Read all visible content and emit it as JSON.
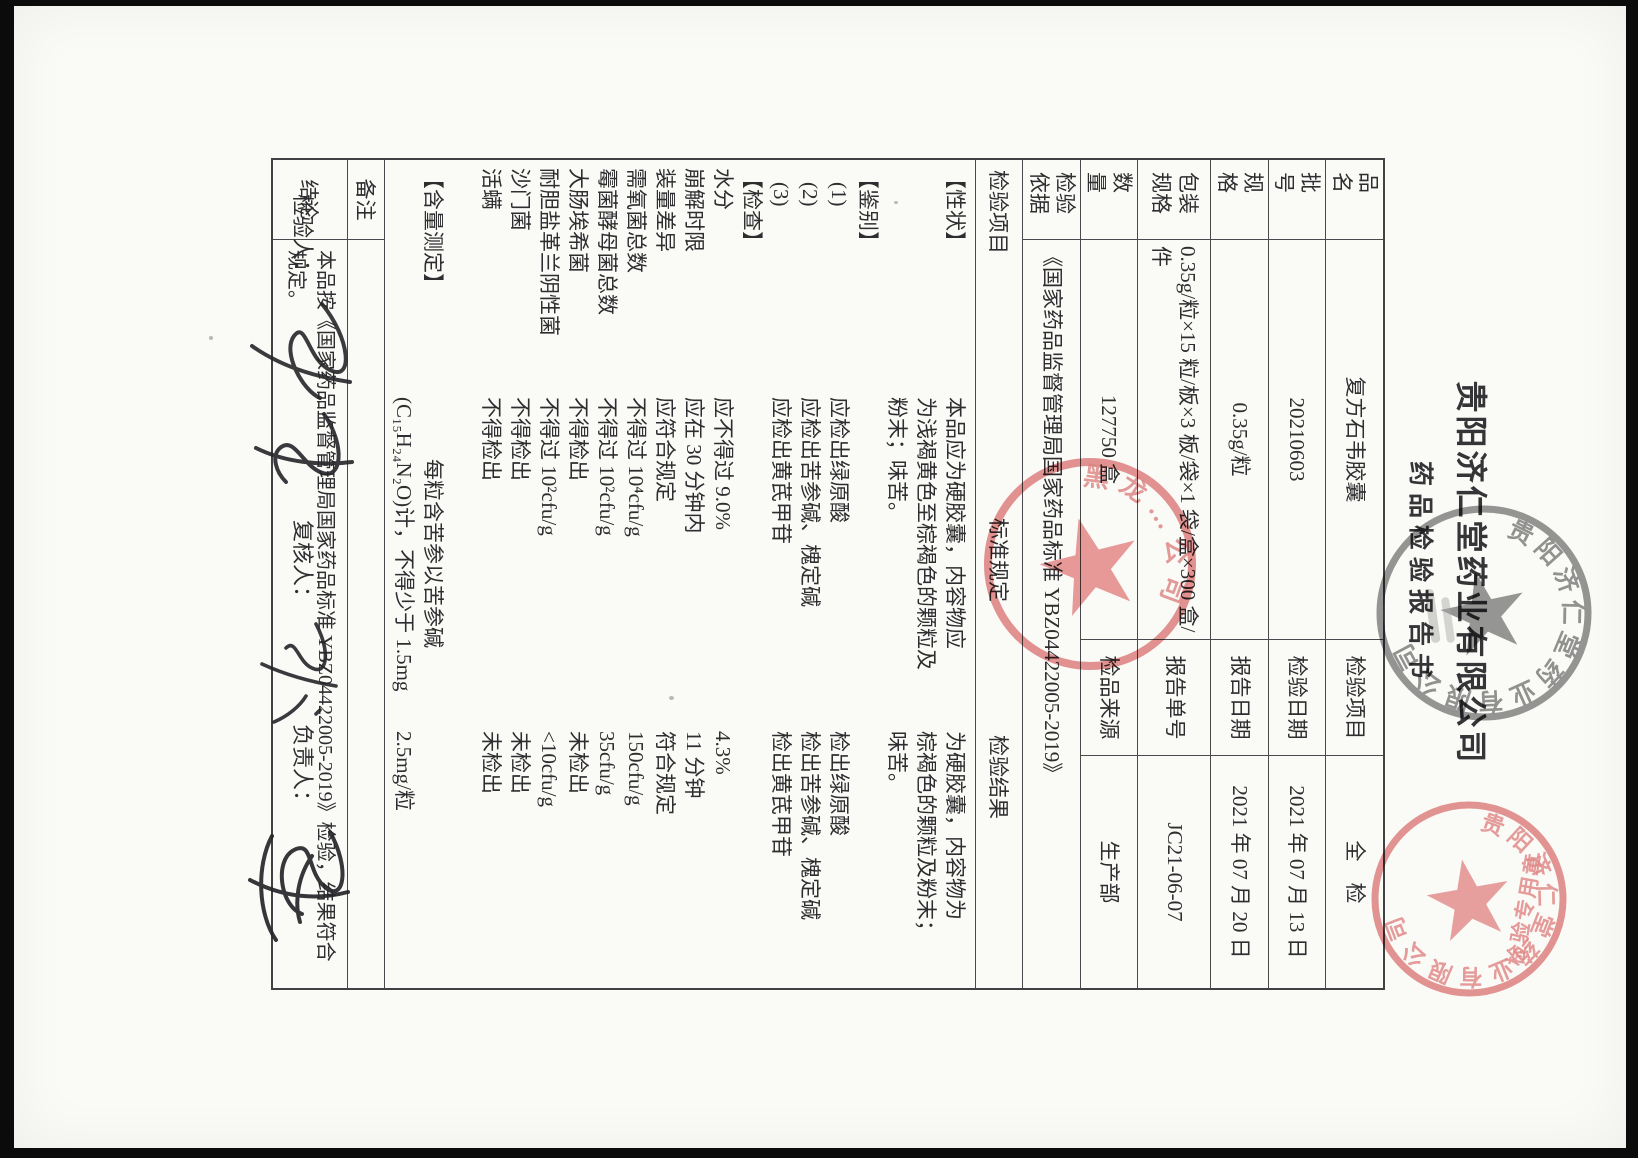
{
  "header": {
    "company_title": "贵阳济仁堂药业有限公司",
    "report_title": "药品检验报告书"
  },
  "info_table": {
    "rows": [
      {
        "label": "品　名",
        "value": "复方石韦胶囊",
        "label2": "检验项目",
        "value2": "全　检"
      },
      {
        "label": "批　号",
        "value": "20210603",
        "label2": "检验日期",
        "value2": "2021 年 07 月 13 日"
      },
      {
        "label": "规　格",
        "value": "0.35g/粒",
        "label2": "报告日期",
        "value2": "2021 年 07 月 20 日"
      },
      {
        "label": "包装规格",
        "value": "0.35g/粒×15 粒/板×3 板/袋×1 袋/盒×300 盒/件",
        "label2": "报告单号",
        "value2": "JC21-06-07"
      },
      {
        "label": "数　量",
        "value": "127750 盒",
        "label2": "检品来源",
        "value2": "生产部"
      },
      {
        "label": "检验依据",
        "value": "《国家药品监督管理局国家药品标准 YBZ04422005-2019》"
      }
    ]
  },
  "result_table": {
    "headers": [
      "检验项目",
      "标准规定",
      "检验结果"
    ],
    "lines": [
      {
        "item": "【性状】",
        "std": "本品应为硬胶囊，内容物应",
        "result": "为硬胶囊，内容物为"
      },
      {
        "item": "",
        "std": "为浅褐黄色至棕褐色的颗粒及",
        "result": "棕褐色的颗粒及粉末；"
      },
      {
        "item": "",
        "std": "粉末；味苦。",
        "result": "味苦。"
      },
      {
        "item": "【鉴别】",
        "std": "",
        "result": ""
      },
      {
        "item": "(1)",
        "std": "应检出绿原酸",
        "result": "检出绿原酸"
      },
      {
        "item": "(2)",
        "std": "应检出苦参碱、槐定碱",
        "result": "检出苦参碱、槐定碱"
      },
      {
        "item": "(3)",
        "std": "应检出黄芪甲苷",
        "result": "检出黄芪甲苷"
      },
      {
        "item": "【检查】",
        "std": "",
        "result": ""
      },
      {
        "item": "水分",
        "std": "应不得过 9.0%",
        "result": "4.3%"
      },
      {
        "item": "崩解时限",
        "std": "应在 30 分钟内",
        "result": "11 分钟"
      },
      {
        "item": "装量差异",
        "std": "应符合规定",
        "result": "符合规定"
      },
      {
        "item": "需氧菌总数",
        "std": "不得过 10⁴cfu/g",
        "result": "150cfu/g"
      },
      {
        "item": "霉菌酵母菌总数",
        "std": "不得过 10²cfu/g",
        "result": "35cfu/g"
      },
      {
        "item": "大肠埃希菌",
        "std": "不得检出",
        "result": "未检出"
      },
      {
        "item": "耐胆盐革兰阴性菌",
        "std": "不得过 10²cfu/g",
        "result": "<10cfu/g"
      },
      {
        "item": "沙门菌",
        "std": "不得检出",
        "result": "未检出"
      },
      {
        "item": "活螨",
        "std": "不得检出",
        "result": "未检出"
      },
      {
        "item": "",
        "std": "",
        "result": ""
      },
      {
        "item": "【含量测定】",
        "std": "每粒含苦参以苦参碱",
        "result": "",
        "std_center": true
      },
      {
        "item": "",
        "std": "(C₁₅H₂₄N₂O)计，不得少于 1.5mg",
        "result": "2.5mg/粒"
      }
    ]
  },
  "remark": {
    "label": "备注",
    "value": ""
  },
  "conclusion": {
    "label": "结论",
    "text": "本品按《国家药品监督管理局国家药品标准 YBZ04422005-2019》检验，结果符合规定。"
  },
  "signatures": {
    "inspector_label": "检验人：",
    "reviewer_label": "复核人：",
    "approver_label": "负责人："
  },
  "stamps": {
    "company_gray": {
      "rim_text": "贵阳济仁堂药业有限公司",
      "color": "#6f6f6f"
    },
    "middle_red": {
      "rim_text": "黑龙…公司",
      "color": "#d85f5f"
    },
    "corner_red": {
      "rim_text": "贵阳济仁堂药业有限公司",
      "inner_text": "检验专用章",
      "color": "#dd6e6e"
    }
  }
}
